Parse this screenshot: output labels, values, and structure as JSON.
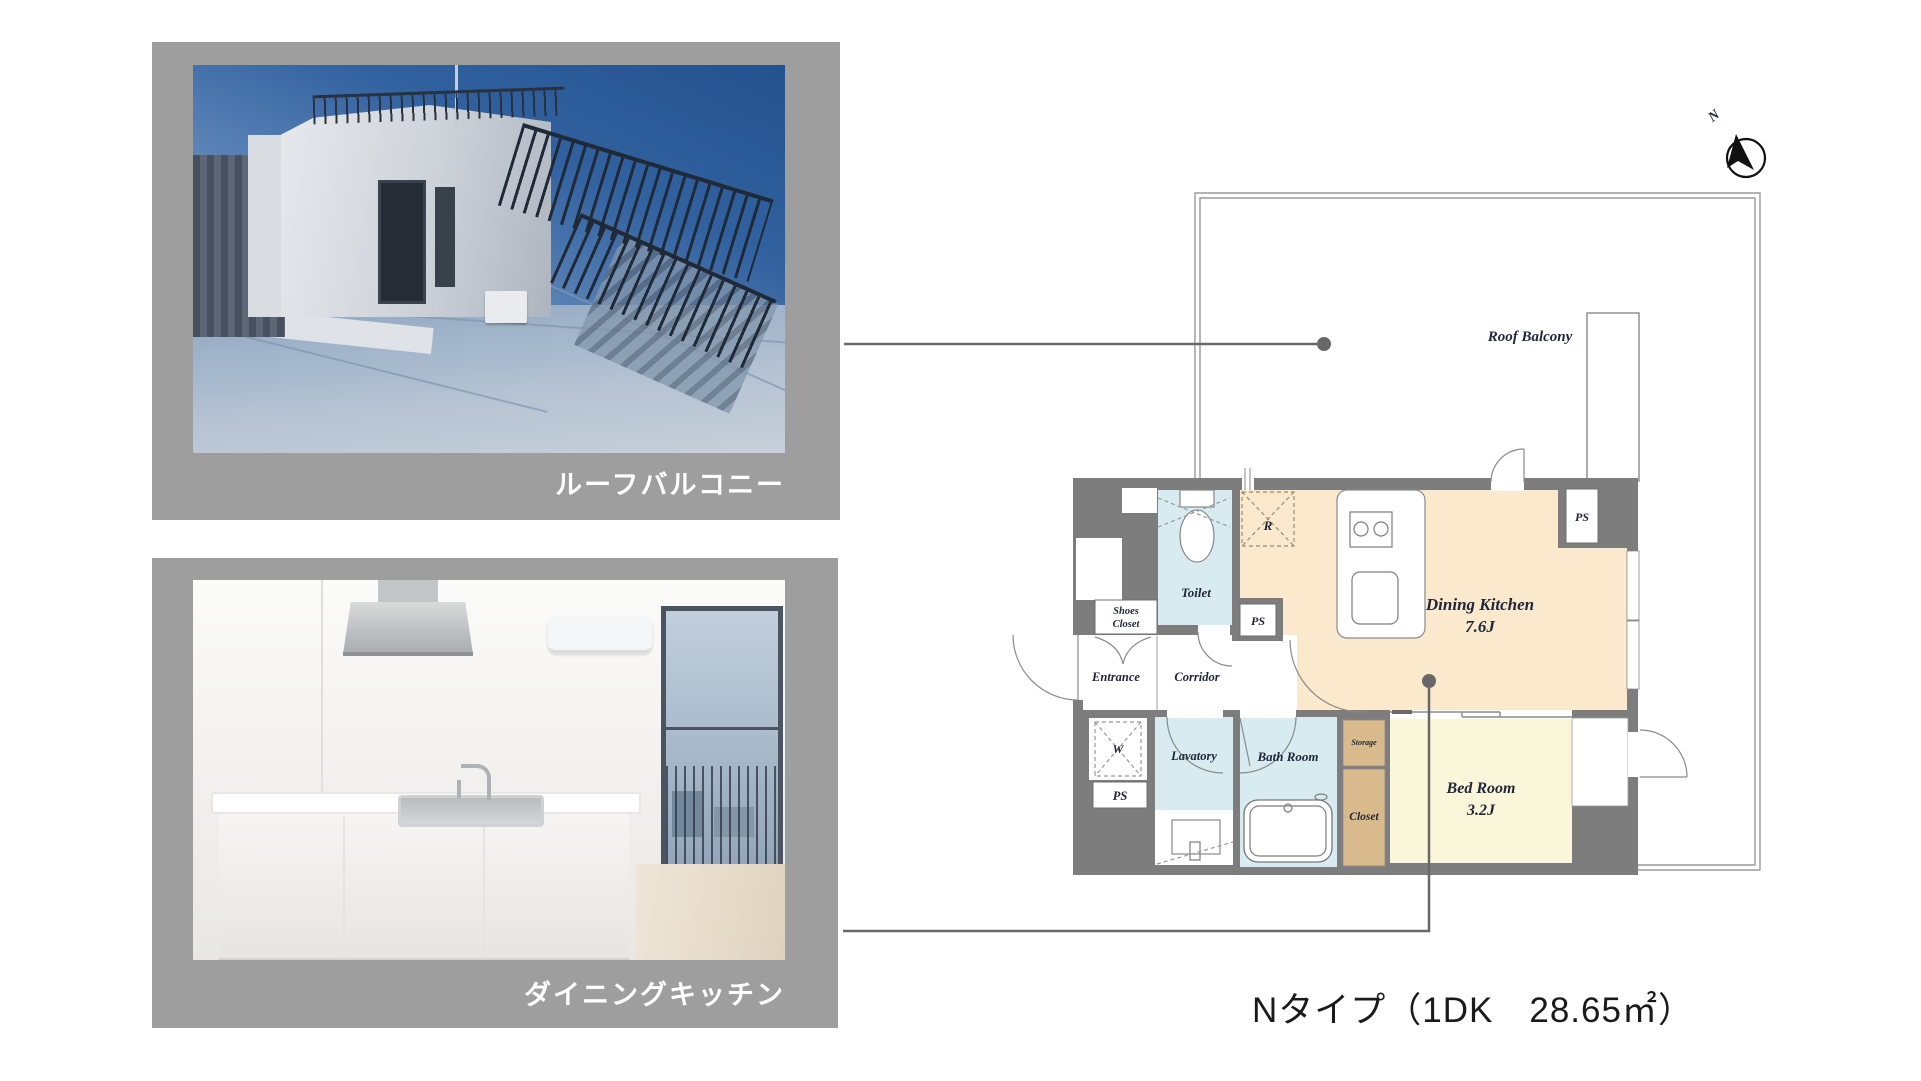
{
  "page": {
    "title_caption": "Nタイプ（1DK　28.65㎡）"
  },
  "photo_cards": [
    {
      "caption": "ルーフバルコニー"
    },
    {
      "caption": "ダイニングキッチン"
    }
  ],
  "floor_plan": {
    "compass": {
      "label": "N"
    },
    "outdoor": {
      "roof_balcony": "Roof Balcony"
    },
    "labels": {
      "dining_kitchen": "Dining Kitchen",
      "dining_kitchen_size": "7.6J",
      "bed_room": "Bed Room",
      "bed_room_size": "3.2J",
      "toilet": "Toilet",
      "entrance": "Entrance",
      "corridor": "Corridor",
      "shoes_closet_lines": [
        "Shoes",
        "Closet"
      ],
      "lavatory": "Lavatory",
      "bath_room": "Bath Room",
      "storage": "Storage",
      "closet": "Closet",
      "ps": "PS",
      "refrigerator": "R",
      "washing_machine": "W"
    },
    "colors": {
      "wall": "#7d7d7d",
      "dining_kitchen_floor": "#fbe9cd",
      "bed_room_floor": "#faf6da",
      "wet_area_floor": "#d8ebf1",
      "closet_fill": "#d9ba8c",
      "panel_gray": "#9e9e9e",
      "connector": "#686868"
    }
  }
}
